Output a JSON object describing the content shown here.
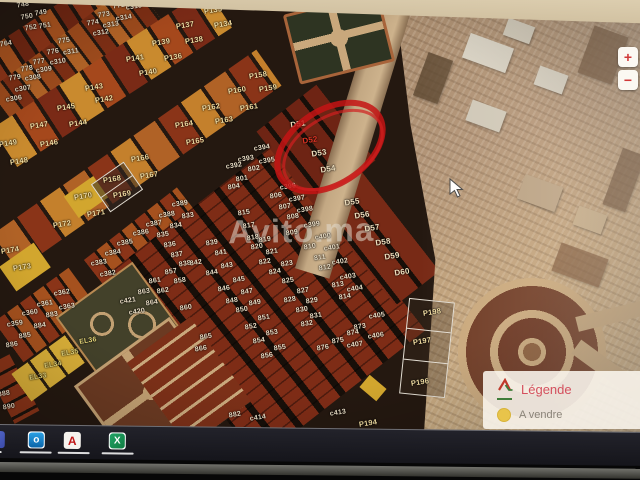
{
  "watermark": "Avito.ma",
  "map": {
    "controls": {
      "zoom_in": "+",
      "zoom_out": "−"
    },
    "annotation": {
      "shape": "ellipse",
      "color": "#c41414",
      "around": [
        "D52",
        "D53",
        "D54"
      ]
    },
    "parcels": [
      {
        "label": "736",
        "x": 239,
        "y": 3
      },
      {
        "label": "748",
        "x": 23,
        "y": 5
      },
      {
        "label": "749",
        "x": 41,
        "y": 13
      },
      {
        "label": "750",
        "x": 27,
        "y": 17
      },
      {
        "label": "751",
        "x": 45,
        "y": 26
      },
      {
        "label": "752",
        "x": 31,
        "y": 28
      },
      {
        "label": "764",
        "x": 6,
        "y": 44
      },
      {
        "label": "772",
        "x": 119,
        "y": 6
      },
      {
        "label": "773",
        "x": 104,
        "y": 15
      },
      {
        "label": "774",
        "x": 93,
        "y": 23
      },
      {
        "label": "775",
        "x": 64,
        "y": 41
      },
      {
        "label": "776",
        "x": 53,
        "y": 52
      },
      {
        "label": "777",
        "x": 39,
        "y": 62
      },
      {
        "label": "778",
        "x": 27,
        "y": 69
      },
      {
        "label": "779",
        "x": 15,
        "y": 78
      },
      {
        "label": "c306",
        "x": 14,
        "y": 99
      },
      {
        "label": "c307",
        "x": 23,
        "y": 89
      },
      {
        "label": "c308",
        "x": 33,
        "y": 78
      },
      {
        "label": "c309",
        "x": 44,
        "y": 70
      },
      {
        "label": "c310",
        "x": 58,
        "y": 62
      },
      {
        "label": "c311",
        "x": 71,
        "y": 52
      },
      {
        "label": "c312",
        "x": 101,
        "y": 33
      },
      {
        "label": "c313",
        "x": 111,
        "y": 25
      },
      {
        "label": "c314",
        "x": 124,
        "y": 18
      },
      {
        "label": "c315",
        "x": 134,
        "y": 7
      },
      {
        "label": "P135",
        "x": 213,
        "y": 10,
        "cls": "p"
      },
      {
        "label": "P134",
        "x": 223,
        "y": 24,
        "cls": "p"
      },
      {
        "label": "P137",
        "x": 185,
        "y": 25,
        "cls": "p"
      },
      {
        "label": "P139",
        "x": 161,
        "y": 42,
        "cls": "p"
      },
      {
        "label": "P138",
        "x": 194,
        "y": 40,
        "cls": "p"
      },
      {
        "label": "P136",
        "x": 173,
        "y": 57,
        "cls": "p"
      },
      {
        "label": "P141",
        "x": 135,
        "y": 58,
        "cls": "p"
      },
      {
        "label": "P140",
        "x": 148,
        "y": 72,
        "cls": "p"
      },
      {
        "label": "P143",
        "x": 94,
        "y": 87,
        "cls": "p"
      },
      {
        "label": "P142",
        "x": 104,
        "y": 99,
        "cls": "p"
      },
      {
        "label": "P145",
        "x": 66,
        "y": 107,
        "cls": "p"
      },
      {
        "label": "P144",
        "x": 78,
        "y": 123,
        "cls": "p"
      },
      {
        "label": "P147",
        "x": 39,
        "y": 125,
        "cls": "p"
      },
      {
        "label": "P146",
        "x": 49,
        "y": 143,
        "cls": "p"
      },
      {
        "label": "P149",
        "x": 8,
        "y": 143,
        "cls": "p"
      },
      {
        "label": "P148",
        "x": 19,
        "y": 161,
        "cls": "p"
      },
      {
        "label": "P158",
        "x": 258,
        "y": 75,
        "cls": "p"
      },
      {
        "label": "P159",
        "x": 268,
        "y": 88,
        "cls": "p"
      },
      {
        "label": "P160",
        "x": 237,
        "y": 90,
        "cls": "p"
      },
      {
        "label": "P161",
        "x": 249,
        "y": 107,
        "cls": "p"
      },
      {
        "label": "P162",
        "x": 211,
        "y": 107,
        "cls": "p"
      },
      {
        "label": "P163",
        "x": 224,
        "y": 120,
        "cls": "p"
      },
      {
        "label": "P164",
        "x": 184,
        "y": 124,
        "cls": "p"
      },
      {
        "label": "P165",
        "x": 195,
        "y": 141,
        "cls": "p"
      },
      {
        "label": "P166",
        "x": 140,
        "y": 158,
        "cls": "p"
      },
      {
        "label": "P167",
        "x": 149,
        "y": 175,
        "cls": "p"
      },
      {
        "label": "P168",
        "x": 112,
        "y": 179,
        "cls": "p"
      },
      {
        "label": "P169",
        "x": 122,
        "y": 194,
        "cls": "p"
      },
      {
        "label": "P170",
        "x": 83,
        "y": 196,
        "cls": "p"
      },
      {
        "label": "P171",
        "x": 96,
        "y": 213,
        "cls": "p"
      },
      {
        "label": "P172",
        "x": 62,
        "y": 224,
        "cls": "p"
      },
      {
        "label": "P174",
        "x": 10,
        "y": 250,
        "cls": "p"
      },
      {
        "label": "P173",
        "x": 22,
        "y": 267,
        "cls": "p"
      },
      {
        "label": "c389",
        "x": 180,
        "y": 204
      },
      {
        "label": "c388",
        "x": 167,
        "y": 215
      },
      {
        "label": "833",
        "x": 188,
        "y": 216
      },
      {
        "label": "c387",
        "x": 154,
        "y": 224
      },
      {
        "label": "834",
        "x": 176,
        "y": 226
      },
      {
        "label": "c386",
        "x": 141,
        "y": 233
      },
      {
        "label": "835",
        "x": 163,
        "y": 235
      },
      {
        "label": "c385",
        "x": 125,
        "y": 243
      },
      {
        "label": "836",
        "x": 170,
        "y": 245
      },
      {
        "label": "c384",
        "x": 113,
        "y": 253
      },
      {
        "label": "837",
        "x": 177,
        "y": 255
      },
      {
        "label": "c383",
        "x": 99,
        "y": 263
      },
      {
        "label": "838",
        "x": 185,
        "y": 264
      },
      {
        "label": "c382",
        "x": 108,
        "y": 274
      },
      {
        "label": "857",
        "x": 171,
        "y": 272
      },
      {
        "label": "861",
        "x": 155,
        "y": 281
      },
      {
        "label": "858",
        "x": 180,
        "y": 281
      },
      {
        "label": "862",
        "x": 163,
        "y": 291
      },
      {
        "label": "863",
        "x": 144,
        "y": 292
      },
      {
        "label": "c421",
        "x": 128,
        "y": 301
      },
      {
        "label": "864",
        "x": 152,
        "y": 303
      },
      {
        "label": "c420",
        "x": 137,
        "y": 312
      },
      {
        "label": "c362",
        "x": 62,
        "y": 293
      },
      {
        "label": "c361",
        "x": 45,
        "y": 304
      },
      {
        "label": "c363",
        "x": 67,
        "y": 307
      },
      {
        "label": "c360",
        "x": 30,
        "y": 313
      },
      {
        "label": "883",
        "x": 52,
        "y": 315
      },
      {
        "label": "c359",
        "x": 15,
        "y": 324
      },
      {
        "label": "884",
        "x": 40,
        "y": 326
      },
      {
        "label": "885",
        "x": 25,
        "y": 336
      },
      {
        "label": "886",
        "x": 12,
        "y": 345
      },
      {
        "label": "888",
        "x": 4,
        "y": 394
      },
      {
        "label": "890",
        "x": 9,
        "y": 407
      },
      {
        "label": "EL36",
        "x": 88,
        "y": 341,
        "cls": "el"
      },
      {
        "label": "EL35",
        "x": 70,
        "y": 353,
        "cls": "el"
      },
      {
        "label": "EL34",
        "x": 53,
        "y": 365,
        "cls": "el"
      },
      {
        "label": "EL33",
        "x": 38,
        "y": 377,
        "cls": "el"
      },
      {
        "label": "839",
        "x": 212,
        "y": 243
      },
      {
        "label": "841",
        "x": 221,
        "y": 253
      },
      {
        "label": "842",
        "x": 196,
        "y": 263
      },
      {
        "label": "843",
        "x": 227,
        "y": 266
      },
      {
        "label": "844",
        "x": 212,
        "y": 273
      },
      {
        "label": "845",
        "x": 239,
        "y": 280
      },
      {
        "label": "846",
        "x": 224,
        "y": 289
      },
      {
        "label": "847",
        "x": 247,
        "y": 292
      },
      {
        "label": "848",
        "x": 232,
        "y": 301
      },
      {
        "label": "849",
        "x": 255,
        "y": 303
      },
      {
        "label": "850",
        "x": 242,
        "y": 310
      },
      {
        "label": "851",
        "x": 264,
        "y": 318
      },
      {
        "label": "852",
        "x": 251,
        "y": 327
      },
      {
        "label": "853",
        "x": 272,
        "y": 333
      },
      {
        "label": "854",
        "x": 259,
        "y": 341
      },
      {
        "label": "855",
        "x": 280,
        "y": 348
      },
      {
        "label": "856",
        "x": 267,
        "y": 356
      },
      {
        "label": "860",
        "x": 186,
        "y": 308
      },
      {
        "label": "865",
        "x": 206,
        "y": 337
      },
      {
        "label": "866",
        "x": 201,
        "y": 349
      },
      {
        "label": "815",
        "x": 244,
        "y": 213
      },
      {
        "label": "817",
        "x": 249,
        "y": 226
      },
      {
        "label": "818",
        "x": 253,
        "y": 238
      },
      {
        "label": "819",
        "x": 265,
        "y": 240
      },
      {
        "label": "820",
        "x": 257,
        "y": 247
      },
      {
        "label": "821",
        "x": 272,
        "y": 252
      },
      {
        "label": "822",
        "x": 265,
        "y": 262
      },
      {
        "label": "823",
        "x": 287,
        "y": 264
      },
      {
        "label": "824",
        "x": 275,
        "y": 272
      },
      {
        "label": "825",
        "x": 288,
        "y": 281
      },
      {
        "label": "827",
        "x": 303,
        "y": 291
      },
      {
        "label": "828",
        "x": 290,
        "y": 300
      },
      {
        "label": "829",
        "x": 312,
        "y": 301
      },
      {
        "label": "830",
        "x": 302,
        "y": 310
      },
      {
        "label": "831",
        "x": 316,
        "y": 316
      },
      {
        "label": "832",
        "x": 307,
        "y": 324
      },
      {
        "label": "c394",
        "x": 262,
        "y": 148
      },
      {
        "label": "c393",
        "x": 246,
        "y": 159
      },
      {
        "label": "c395",
        "x": 267,
        "y": 161
      },
      {
        "label": "c392",
        "x": 234,
        "y": 166
      },
      {
        "label": "802",
        "x": 254,
        "y": 169
      },
      {
        "label": "801",
        "x": 242,
        "y": 179
      },
      {
        "label": "804",
        "x": 234,
        "y": 187
      },
      {
        "label": "c396",
        "x": 288,
        "y": 187
      },
      {
        "label": "806",
        "x": 276,
        "y": 196
      },
      {
        "label": "c397",
        "x": 297,
        "y": 199
      },
      {
        "label": "807",
        "x": 285,
        "y": 207
      },
      {
        "label": "c398",
        "x": 305,
        "y": 210
      },
      {
        "label": "808",
        "x": 293,
        "y": 217
      },
      {
        "label": "c399",
        "x": 312,
        "y": 225
      },
      {
        "label": "809",
        "x": 292,
        "y": 233
      },
      {
        "label": "c400",
        "x": 323,
        "y": 237
      },
      {
        "label": "810",
        "x": 310,
        "y": 247
      },
      {
        "label": "c401",
        "x": 332,
        "y": 248
      },
      {
        "label": "811",
        "x": 320,
        "y": 258
      },
      {
        "label": "c402",
        "x": 340,
        "y": 262
      },
      {
        "label": "812",
        "x": 325,
        "y": 268
      },
      {
        "label": "c403",
        "x": 348,
        "y": 277
      },
      {
        "label": "813",
        "x": 338,
        "y": 285
      },
      {
        "label": "c404",
        "x": 355,
        "y": 289
      },
      {
        "label": "814",
        "x": 345,
        "y": 297
      },
      {
        "label": "873",
        "x": 360,
        "y": 327
      },
      {
        "label": "874",
        "x": 353,
        "y": 333
      },
      {
        "label": "875",
        "x": 338,
        "y": 341
      },
      {
        "label": "876",
        "x": 323,
        "y": 348
      },
      {
        "label": "c407",
        "x": 355,
        "y": 345
      },
      {
        "label": "882",
        "x": 235,
        "y": 415
      },
      {
        "label": "c414",
        "x": 258,
        "y": 418
      },
      {
        "label": "c413",
        "x": 338,
        "y": 413
      },
      {
        "label": "P194",
        "x": 368,
        "y": 423,
        "cls": "p"
      },
      {
        "label": "D51",
        "x": 298,
        "y": 124,
        "cls": "d"
      },
      {
        "label": "D52",
        "x": 310,
        "y": 140,
        "cls": "sel"
      },
      {
        "label": "D53",
        "x": 319,
        "y": 153,
        "cls": "d"
      },
      {
        "label": "D54",
        "x": 328,
        "y": 169,
        "cls": "d"
      },
      {
        "label": "D55",
        "x": 352,
        "y": 202,
        "cls": "d"
      },
      {
        "label": "D56",
        "x": 362,
        "y": 215,
        "cls": "d"
      },
      {
        "label": "D57",
        "x": 372,
        "y": 228,
        "cls": "d"
      },
      {
        "label": "D58",
        "x": 383,
        "y": 242,
        "cls": "d"
      },
      {
        "label": "D59",
        "x": 392,
        "y": 256,
        "cls": "d"
      },
      {
        "label": "D60",
        "x": 402,
        "y": 272,
        "cls": "d"
      },
      {
        "label": "c405",
        "x": 377,
        "y": 316
      },
      {
        "label": "c406",
        "x": 376,
        "y": 336
      },
      {
        "label": "P198",
        "x": 432,
        "y": 312,
        "cls": "p"
      },
      {
        "label": "P197",
        "x": 422,
        "y": 341,
        "cls": "p"
      },
      {
        "label": "P196",
        "x": 420,
        "y": 382,
        "cls": "p"
      }
    ]
  },
  "legend": {
    "title": "Légende",
    "items": [
      {
        "label": "A vendre",
        "color": "#e8c44a"
      }
    ]
  },
  "taskbar": {
    "icons": [
      {
        "name": "outlook",
        "letter": "o"
      },
      {
        "name": "autocad",
        "letter": "A"
      },
      {
        "name": "excel",
        "letter": "X"
      }
    ]
  }
}
